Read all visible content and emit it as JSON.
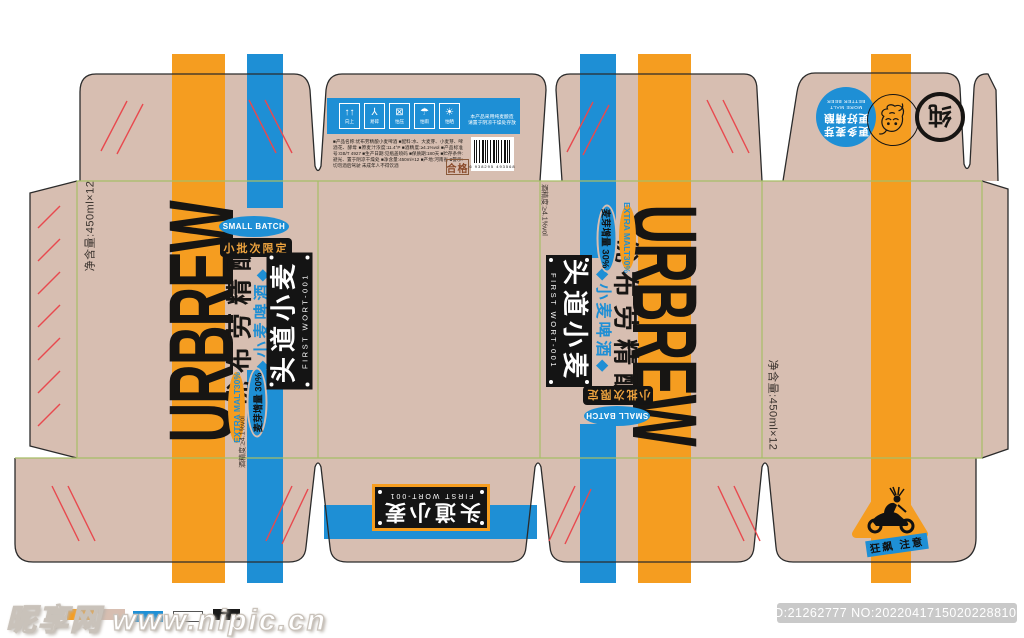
{
  "colors": {
    "cardboard": "#D7BEB1",
    "orange": "#F59D20",
    "blue": "#1E8FD5",
    "black": "#141414",
    "fold_line_green": "#A6BE67",
    "crease_red": "#E8494E"
  },
  "brand": {
    "name_en": "URBREW",
    "name_cn": "优布劳精酿",
    "product_cn": "◆小麦啤酒◆",
    "small_batch_en": "SMALL BATCH",
    "small_batch_cn": "小批次限定",
    "extra_malt_en": "EXTRA MALT30%",
    "extra_malt_cn": "麦芽增量 30%",
    "label_title": "头道小麦",
    "label_sub": "FIRST WORT-001",
    "net_content": "净含量:450ml×12",
    "alcohol": "酒精度:≥4.1%vol"
  },
  "top_flap": {
    "icons": [
      {
        "name": "keep-upright-icon",
        "glyph": "↑↑",
        "label": "向上"
      },
      {
        "name": "fragile-icon",
        "glyph": "⅄",
        "label": "易碎"
      },
      {
        "name": "stacking-limit-icon",
        "glyph": "⊠",
        "label": "怕压"
      },
      {
        "name": "keep-dry-icon",
        "glyph": "☂",
        "label": "怕雨"
      },
      {
        "name": "keep-away-sun-icon",
        "glyph": "☀",
        "label": "怕晒"
      }
    ],
    "notice_line1": "本产品采用纯麦酿造",
    "notice_line2": "请置于阴凉干燥处存放",
    "info_text": "■产品名称:优布劳精酿小麦啤酒 ■配料:水、大麦芽、小麦芽、啤酒花、酵母 ■原麦汁浓度:11.4°P ■酒精度:≥4.1%vol ■产品标准号:GB/T 4927 ■生产日期:见瓶盖喷码 ■保质期:180天 ■贮存条件:避光、置于阴凉干燥处 ■净含量:450ml×12 ■产地:河南省 ■警示:切勿酒后驾驶 未成年人不得饮酒",
    "qualified": "合格",
    "barcode_digits": "6 938295 493568"
  },
  "badges": {
    "more_malt_cn1": "更多麦芽",
    "more_malt_cn2": "更好精酿",
    "more_malt_en1": "MORE MALT",
    "more_malt_en2": "BETTER BEER",
    "ring_char": "纯"
  },
  "warning": {
    "tag": "狂飙 注意"
  },
  "footer": {
    "watermark": "昵享网 www.nipic.cn",
    "id_text": "ID:21262777 NO:20220417150202288107",
    "swatches": [
      "#F59D20",
      "#D7BEB1",
      "#1E8FD5",
      "#FFFFFF",
      "#1A1A1A"
    ]
  }
}
